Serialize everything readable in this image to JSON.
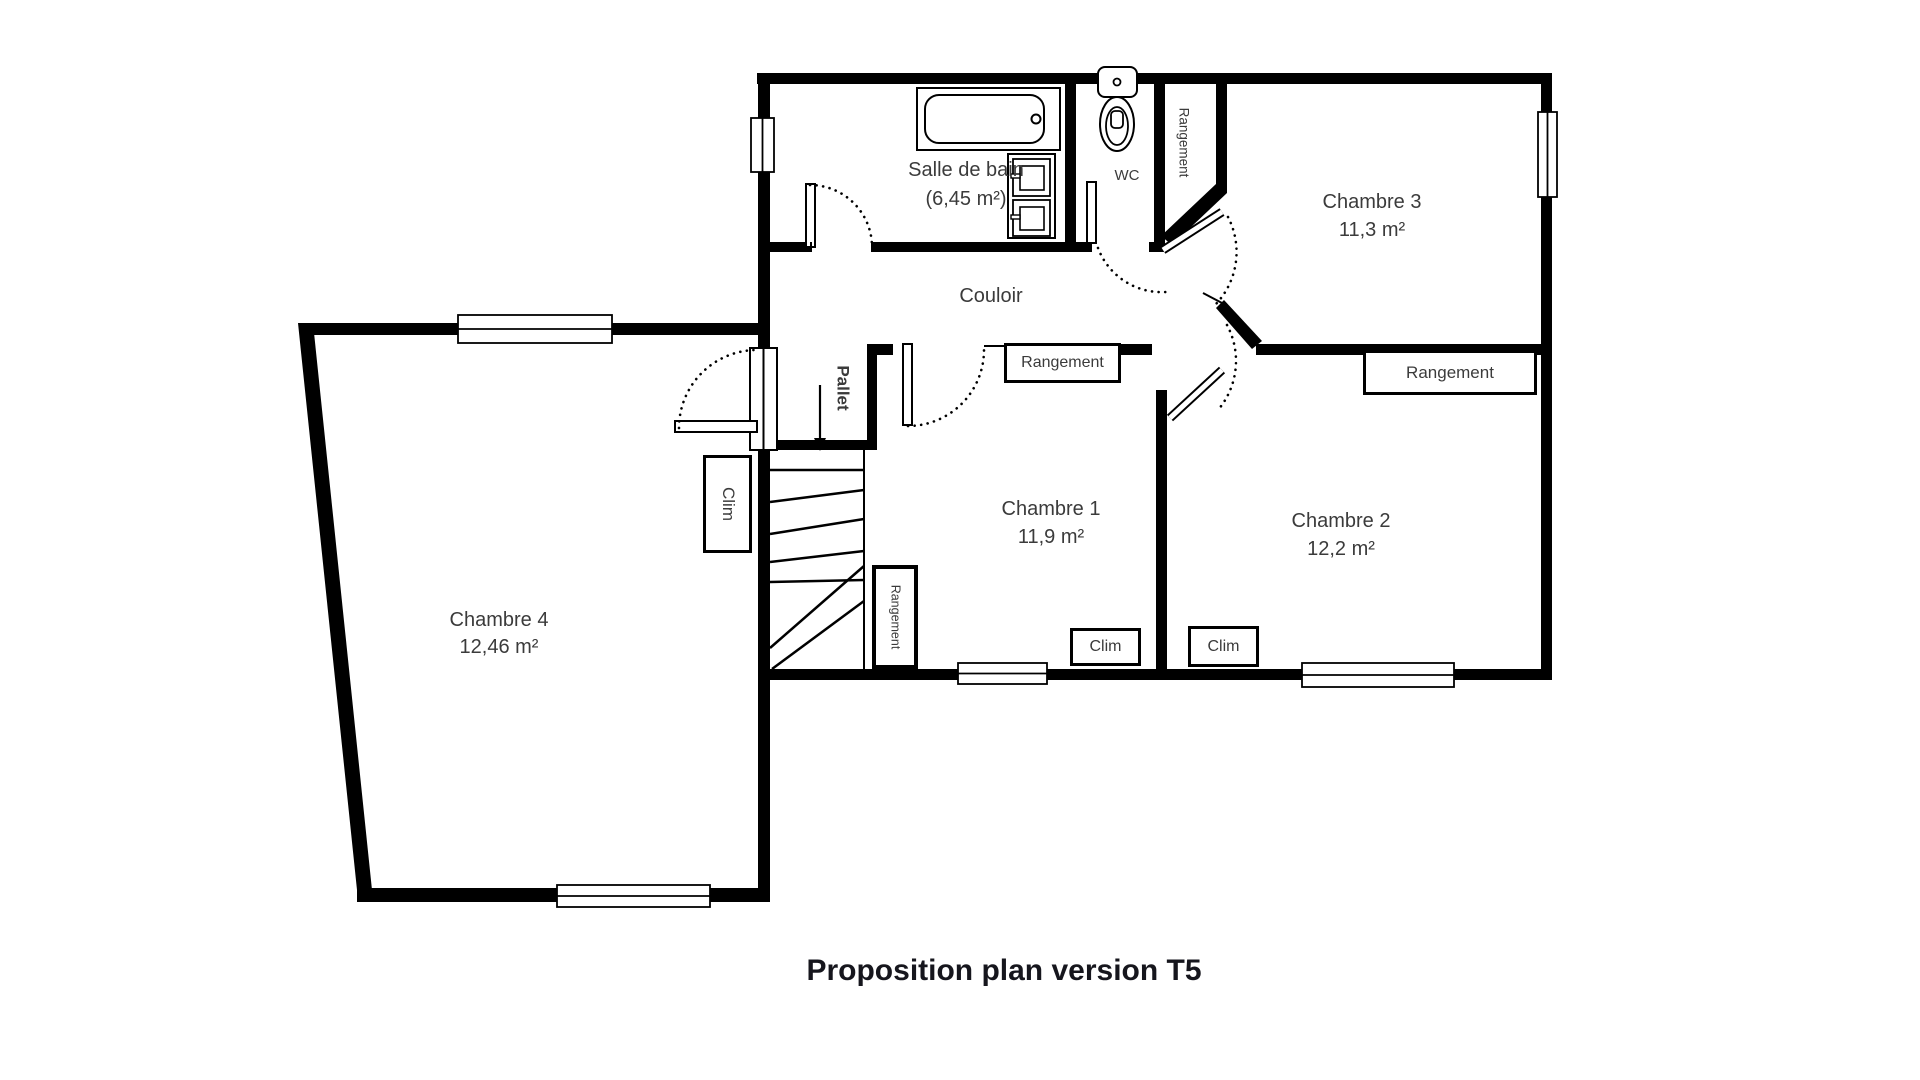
{
  "title": "Proposition plan version T5",
  "rooms": {
    "salle_de_bain": {
      "name": "Salle de bain",
      "area": "(6,45 m²)"
    },
    "wc": {
      "name": "WC"
    },
    "couloir": {
      "name": "Couloir"
    },
    "chambre1": {
      "name": "Chambre 1",
      "area": "11,9 m²"
    },
    "chambre2": {
      "name": "Chambre 2",
      "area": "12,2 m²"
    },
    "chambre3": {
      "name": "Chambre 3",
      "area": "11,3 m²"
    },
    "chambre4": {
      "name": "Chambre 4",
      "area": "12,46 m²"
    }
  },
  "annotations": {
    "rangement_wc_closet": "Rangement",
    "rangement_chambre1": "Rangement",
    "rangement_chambre3": "Rangement",
    "rangement_stairs": "Rangement",
    "clim_stairs": "Clim",
    "clim_chambre1": "Clim",
    "clim_chambre2": "Clim",
    "pallet": "Pallet"
  },
  "colors": {
    "wall": "#000000",
    "label_text": "#3b3b3b",
    "title_text": "#16161d"
  }
}
